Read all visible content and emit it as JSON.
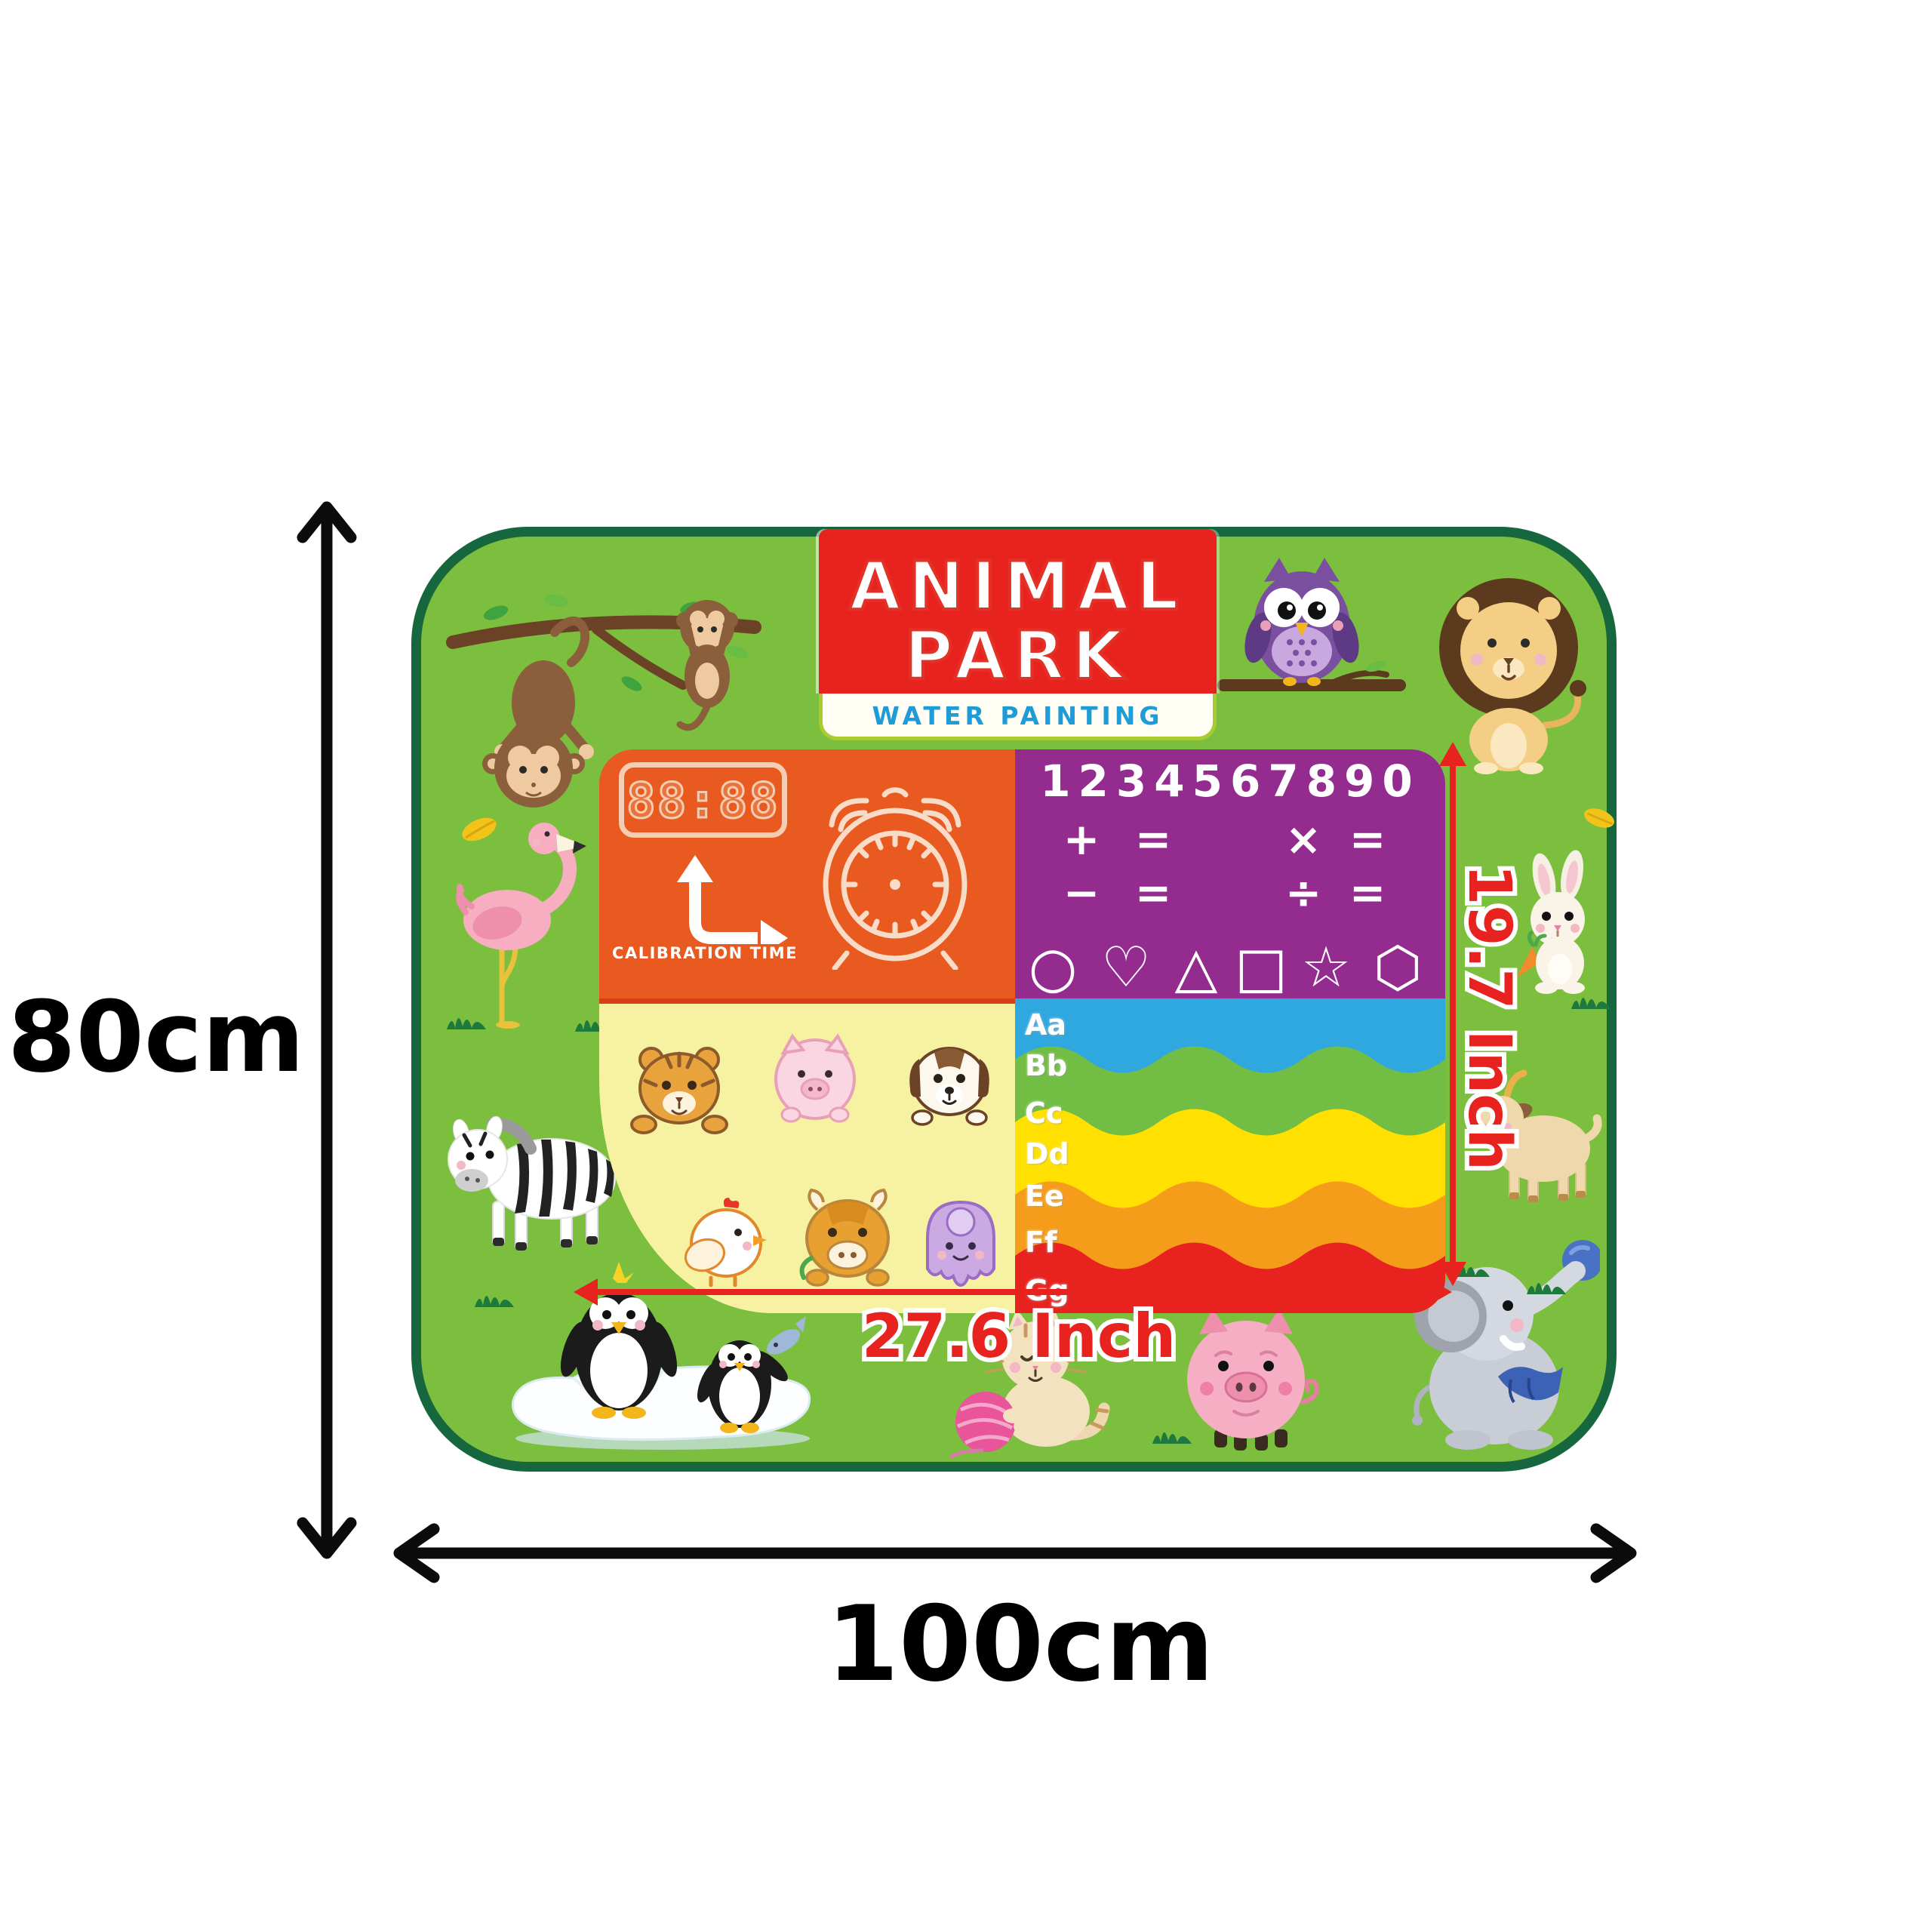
{
  "dimension_labels": {
    "outer_height": "80cm",
    "outer_width": "100cm",
    "inner_height": "19.7 Inch",
    "inner_width": "27.6 Inch"
  },
  "title_block": {
    "line1": "ANIMAL",
    "line2": "PARK",
    "subtitle": "WATER PAINTING"
  },
  "clock_panel": {
    "digital_display": "88:88",
    "caption": "CALIBRATION TIME"
  },
  "math_panel": {
    "numbers": "1234567890",
    "op_rows": [
      [
        "+",
        "=",
        "×",
        "="
      ],
      [
        "−",
        "=",
        "÷",
        "="
      ]
    ],
    "shape_names": [
      "circle",
      "heart",
      "triangle",
      "square",
      "star",
      "hexagon"
    ],
    "shape_glyphs": [
      "○",
      "♡",
      "△",
      "□",
      "☆",
      "⬡"
    ]
  },
  "alphabet_panel": {
    "letters": [
      "Aa",
      "Bb",
      "Cc",
      "Dd",
      "Ee",
      "Ff",
      "Gg"
    ],
    "band_colors": [
      "#2FA8DF",
      "#72BE44",
      "#FFE000",
      "#F59C1B",
      "#E8231F"
    ]
  },
  "sticker_panel": {
    "animals": [
      "tiger cub",
      "pig",
      "puppy",
      "chicken",
      "ox",
      "octopus"
    ]
  },
  "mat": {
    "animals": [
      "monkeys on branch",
      "owl on branch",
      "lion",
      "flamingo",
      "zebra",
      "rabbit with carrot",
      "goat",
      "penguins on ice floe",
      "kitten with yarn ball",
      "pig",
      "elephant with ball"
    ],
    "colors": {
      "mat_green": "#7CBE3E",
      "border_green": "#16673E",
      "panel_orange": "#E85A20",
      "panel_purple": "#942B8E",
      "panel_yellow": "#F6F2A2",
      "title_red": "#E8231F",
      "subtitle_blue": "#1E9CD7",
      "dimension_red": "#E8231F",
      "dimension_black": "#000000"
    }
  }
}
